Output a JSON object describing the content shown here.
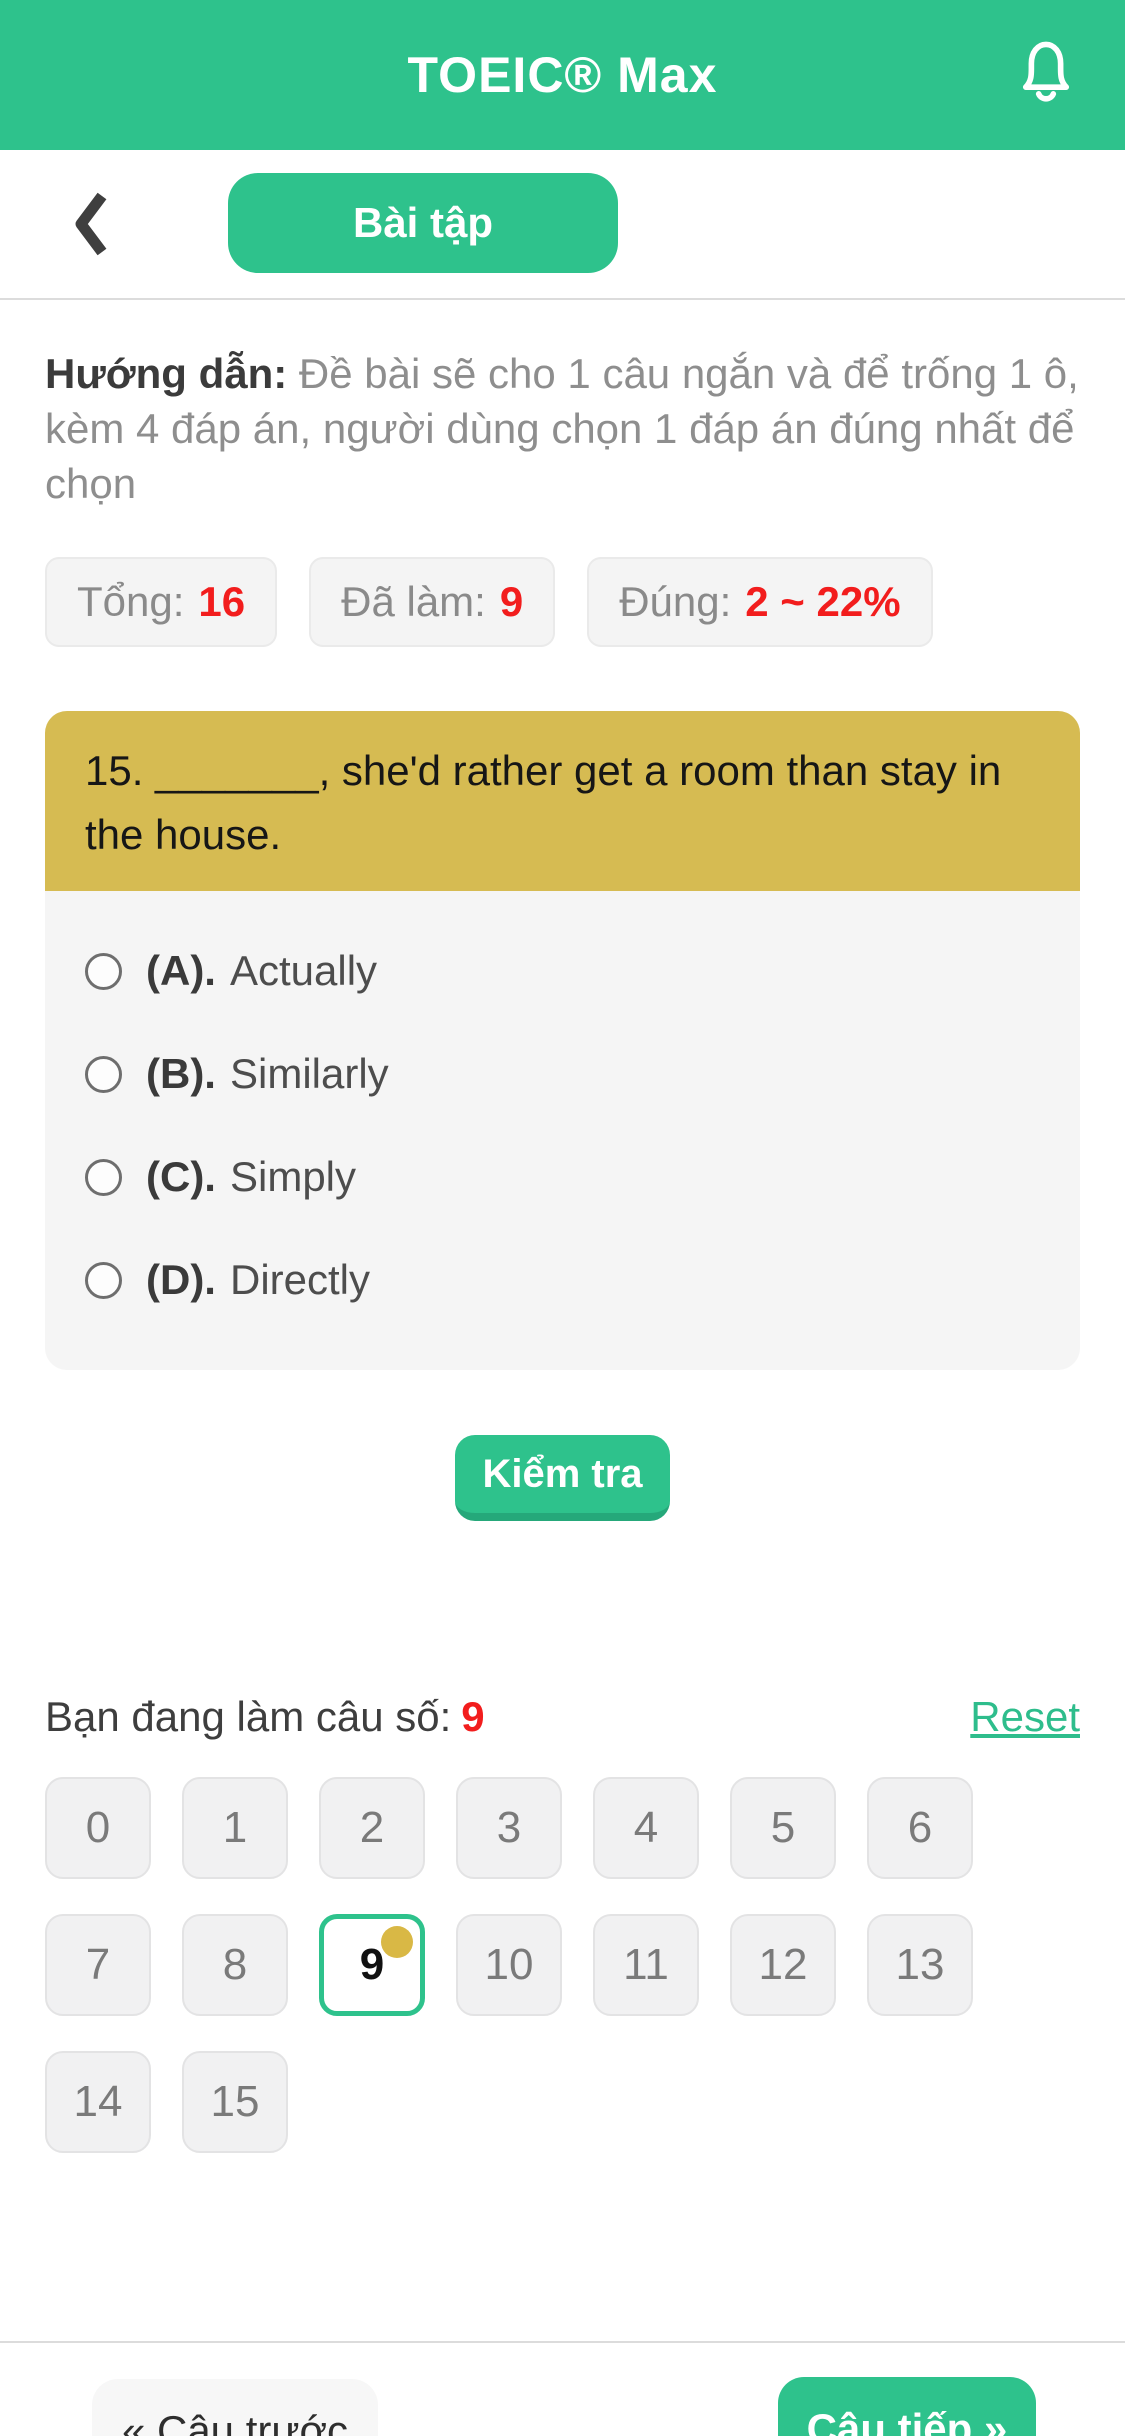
{
  "header": {
    "title": "TOEIC® Max"
  },
  "toolbar": {
    "tab_label": "Bài tập"
  },
  "instructions": {
    "label": "Hướng dẫn:",
    "text": "Đề bài sẽ cho 1 câu ngắn và để trống 1 ô, kèm 4 đáp án, người dùng chọn 1 đáp án đúng nhất để chọn"
  },
  "stats": [
    {
      "label": "Tổng:",
      "value": "16"
    },
    {
      "label": "Đã làm:",
      "value": "9"
    },
    {
      "label": "Đúng:",
      "value": "2 ~ 22%"
    }
  ],
  "question": {
    "prompt": "15. _______, she'd rather get a room than stay in the house.",
    "options": [
      {
        "key": "(A).",
        "text": "Actually"
      },
      {
        "key": "(B).",
        "text": "Similarly"
      },
      {
        "key": "(C).",
        "text": "Simply"
      },
      {
        "key": "(D).",
        "text": "Directly"
      }
    ]
  },
  "check_button_label": "Kiểm tra",
  "progress": {
    "label": "Bạn đang làm câu số:",
    "current": "9",
    "reset_label": "Reset"
  },
  "nav_grid": {
    "numbers": [
      "0",
      "1",
      "2",
      "3",
      "4",
      "5",
      "6",
      "7",
      "8",
      "9",
      "10",
      "11",
      "12",
      "13",
      "14",
      "15"
    ],
    "active_number": "9"
  },
  "footer": {
    "prev_label": "« Câu trước",
    "next_label": "Câu tiếp »"
  },
  "colors": {
    "primary_green": "#2EC28C",
    "dark_green_edge": "#25A87A",
    "question_yellow": "#D6BB52",
    "active_dot_gold": "#D9B845",
    "value_red": "#F21D1D"
  }
}
